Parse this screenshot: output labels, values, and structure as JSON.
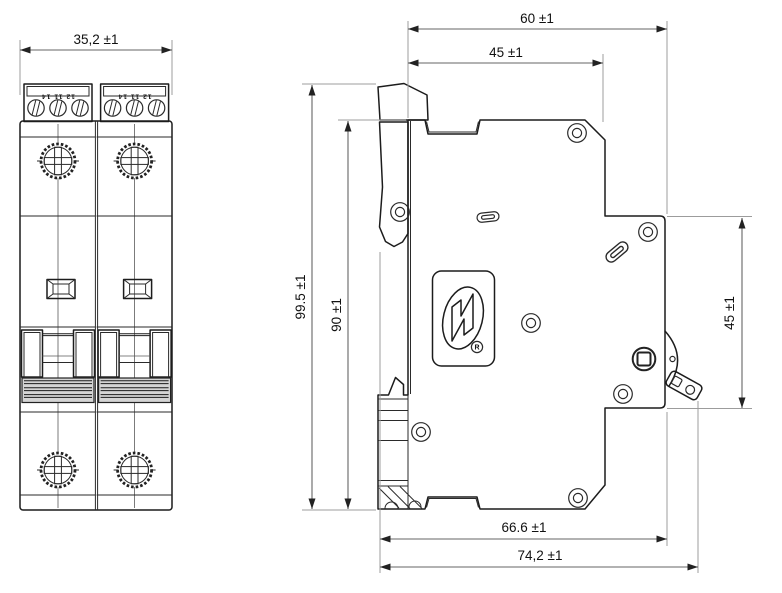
{
  "drawing": {
    "type": "mcb-dimension-drawing",
    "front_view": {
      "width_dim": "35,2 ±1",
      "terminal_marking": "12 11 14"
    },
    "side_view": {
      "total_depth_dim": "60 ±1",
      "front_depth_dim": "45 ±1",
      "total_height_dim": "99.5 ±1",
      "body_height_dim": "90 ±1",
      "din_section_height_dim": "45 ±1",
      "toggle_to_back_dim": "66.6 ±1",
      "toggle_to_clip_dim": "74,2 ±1",
      "logo_registered_mark": "R"
    },
    "colors": {
      "line": "#1c1c1c",
      "extension_line": "#9c9c9c",
      "dimension_line": "#666666",
      "text": "#111111",
      "background": "#ffffff"
    }
  }
}
